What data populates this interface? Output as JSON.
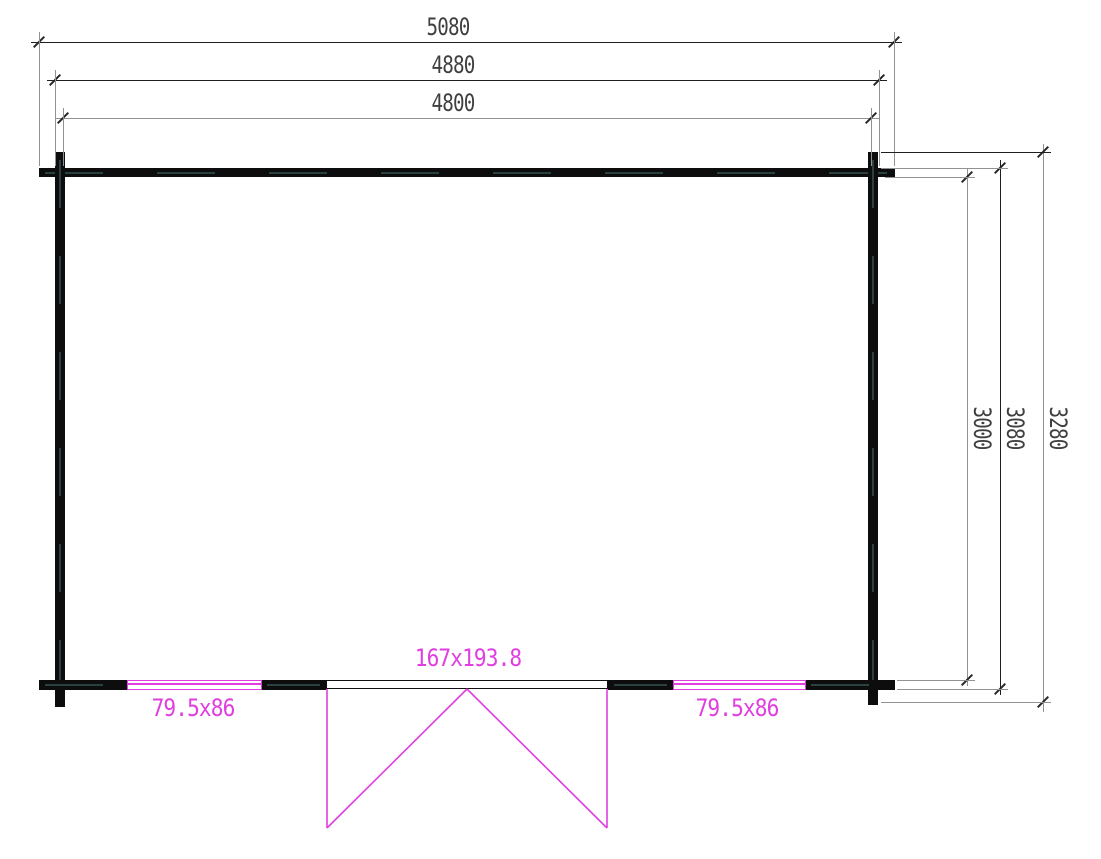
{
  "colors": {
    "magenta": "#e03ee0",
    "wall": "#0d0d0d",
    "dim-dark": "#1f1f1f",
    "dim-gray": "#929292",
    "text": "#3f3f3f",
    "wall-dash": "#2e4a4a",
    "bg": "#ffffff"
  },
  "dimensions": {
    "top": [
      {
        "id": "overall-width",
        "label": "5080"
      },
      {
        "id": "log-end-width",
        "label": "4880"
      },
      {
        "id": "wall-width",
        "label": "4800"
      }
    ],
    "right": [
      {
        "id": "wall-depth",
        "label": "3000"
      },
      {
        "id": "log-end-depth",
        "label": "3080"
      },
      {
        "id": "overall-depth",
        "label": "3280"
      }
    ]
  },
  "openings": {
    "door": {
      "label": "167x193.8"
    },
    "left_window": {
      "label": "79.5x86"
    },
    "right_window": {
      "label": "79.5x86"
    }
  }
}
